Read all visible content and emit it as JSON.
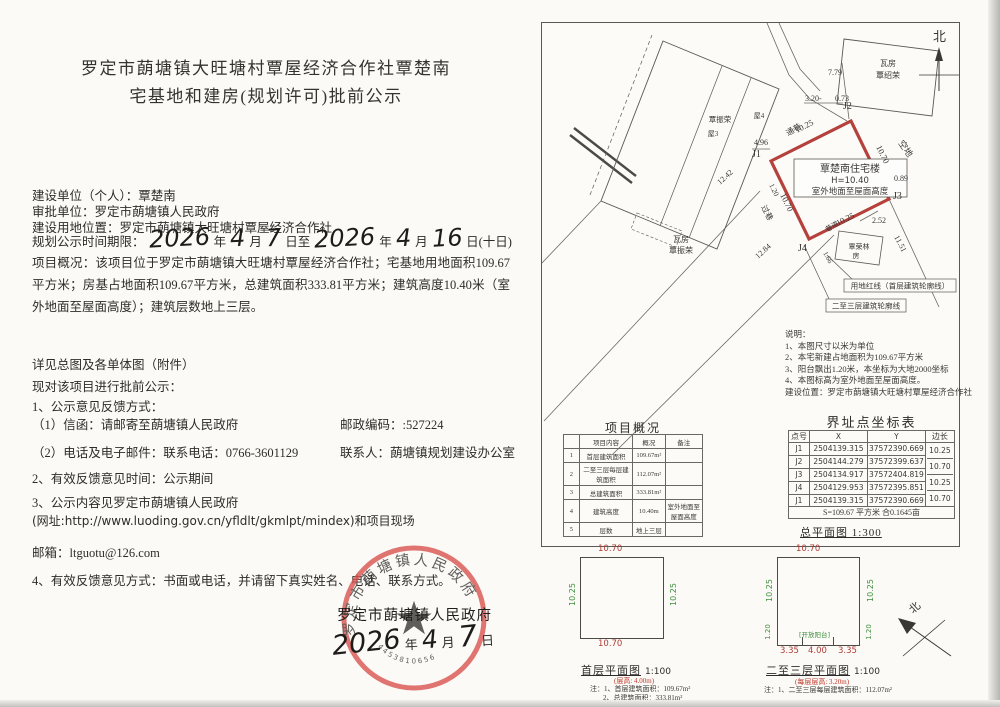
{
  "notice": {
    "title1": "罗定市蓢塘镇大旺塘村覃屋经济合作社覃楚南",
    "title2": "宅基地和建房(规划许可)批前公示",
    "unit": "建设单位（个人）：覃楚南",
    "approver": "审批单位：罗定市蓢塘镇人民政府",
    "location": "建设用地位置：罗定市蓢塘镇大旺塘村覃屋经济合作社",
    "period_label": "规划公示时间期限：",
    "year_label": "年",
    "month_label": "月",
    "day_to_label": "日至",
    "day_tail_label": "日(十日)",
    "hw_year1": "2026",
    "hw_month1": "4",
    "hw_day1": "7",
    "hw_year2": "2026",
    "hw_month2": "4",
    "hw_day2": "16",
    "overview": "项目概况：该项目位于罗定市蓢塘镇大旺塘村覃屋经济合作社；宅基地用地面积109.67平方米；房基占地面积109.67平方米，总建筑面积333.81平方米；建筑高度10.40米（室外地面至屋面高度）；建筑层数地上三层。",
    "attach": "详见总图及各单体图（附件）",
    "announce": "现对该项目进行批前公示：",
    "item1": "1、公示意见反馈方式：",
    "item1_mail": "（1）信函：请邮寄至蓢塘镇人民政府",
    "postcode": "邮政编码：:527224",
    "item1_phone": "（2）电话及电子邮件：联系电话：0766-3601129",
    "contact": "联系人：蓢塘镇规划建设办公室",
    "item2": "2、有效反馈意见时间：公示期间",
    "item3": "3、公示内容见罗定市蓢塘镇人民政府",
    "item3_url": "(网址:http://www.luoding.gov.cn/yfldlt/gkmlpt/mindex)和项目现场",
    "email": "邮箱：ltguotu@126.com",
    "item4": "4、有效反馈意见方式：书面或电话，并请留下真实姓名、电话、联系方式。",
    "gov_name": "罗定市蓢塘镇人民政府",
    "date_year": "2026",
    "date_month": "4",
    "date_day": "7",
    "date_day_label": "日"
  },
  "seal": {
    "arc_text": "罗定市蓢塘镇人民政府",
    "star": "★",
    "code": "4453810656",
    "color": "#d9534f"
  },
  "plan": {
    "north": "北",
    "shed_top1": "瓦房",
    "shed_top2": "覃绍荣",
    "big_owner": "覃振荣",
    "room4": "屋4",
    "room3": "屋3",
    "shed_left1": "瓦房",
    "shed_left2": "覃振荣",
    "qrl1": "覃荣林",
    "qrl2": "房",
    "alley_top": "通巷",
    "alley_left": "过巷",
    "alley_bottom": "巷道",
    "empty_lot": "空地",
    "d779": "7.79",
    "d320": "3.20-",
    "d073": "0.73",
    "d496": "4.96",
    "d1242": "12.42",
    "d1284": "12.84",
    "d1151": "11.51",
    "d252": "2.52",
    "d166": "1.66",
    "d089": "0.89",
    "g_top": "10.25",
    "g_right": "10.70",
    "g_left": "10.70",
    "g_bottom": "10.25",
    "g_balcony": "1.20",
    "J1": "J1",
    "J2": "J2",
    "J3": "J3",
    "J4": "J4",
    "plot1": "覃楚南住宅楼",
    "plot2": "H=10.40",
    "plot3": "室外地面至屋面高度",
    "callout1": "用地红线（首层建筑轮廓线）",
    "callout2": "二至三层建筑轮廓线",
    "notes0": "说明：",
    "notes1": "1、本图尺寸以米为单位",
    "notes2": "2、本宅新建占地面积为109.67平方米",
    "notes3": "3、阳台飘出1.20米，本坐标为大地2000坐标",
    "notes4": "4、本图标高为室外地面至屋面高度。",
    "notes5": "建设位置：罗定市蓢塘镇大旺塘村覃屋经济合作社",
    "caption": "总平面图  1:300"
  },
  "project_table": {
    "title": "项目概况",
    "headers": [
      "",
      "项目内容",
      "概况",
      "备注"
    ],
    "rows": [
      [
        "1",
        "首层建筑面积",
        "109.67m²",
        ""
      ],
      [
        "2",
        "二至三层每层建筑面积",
        "112.07m²",
        ""
      ],
      [
        "3",
        "总建筑面积",
        "333.81m²",
        ""
      ],
      [
        "4",
        "建筑高度",
        "10.40m",
        "室外地面至屋面高度"
      ],
      [
        "5",
        "层数",
        "地上三层",
        ""
      ]
    ]
  },
  "coord_table": {
    "title": "界址点坐标表",
    "headers": [
      "点号",
      "X",
      "Y",
      "边长"
    ],
    "rows": [
      {
        "p": "J1",
        "x": "2504139.315",
        "y": "37572390.669"
      },
      {
        "p": "J2",
        "x": "2504144.279",
        "y": "37572399.637"
      },
      {
        "p": "J3",
        "x": "2504134.917",
        "y": "37572404.819"
      },
      {
        "p": "J4",
        "x": "2504129.953",
        "y": "37572395.851"
      },
      {
        "p": "J1",
        "x": "2504139.315",
        "y": "37572390.669"
      }
    ],
    "edges": [
      "10.25",
      "10.70",
      "10.25",
      "10.70"
    ],
    "summary": "S=109.67 平方米 合0.1645亩"
  },
  "floor1": {
    "top": "10.70",
    "bottom": "10.70",
    "left": "10.25",
    "right": "10.25",
    "caption": "首层平面图",
    "scale": "1:100",
    "hnote": "(层高: 4.00m)",
    "note1": "注：1、首层建筑面积：109.67m²",
    "note2": "2、总建筑面积：333.81m²"
  },
  "floor2": {
    "top": "10.70",
    "left": "10.25",
    "right": "10.25",
    "bl": "1.20",
    "br": "1.20",
    "balcony": "[开放阳台]",
    "d1": "3.35",
    "d2": "4.00",
    "d3": "3.35",
    "caption": "二至三层平面图",
    "scale": "1:100",
    "hnote": "(每层层高: 3.20m)",
    "note1": "注：1、二至三层每层建筑面积：112.07m²"
  }
}
